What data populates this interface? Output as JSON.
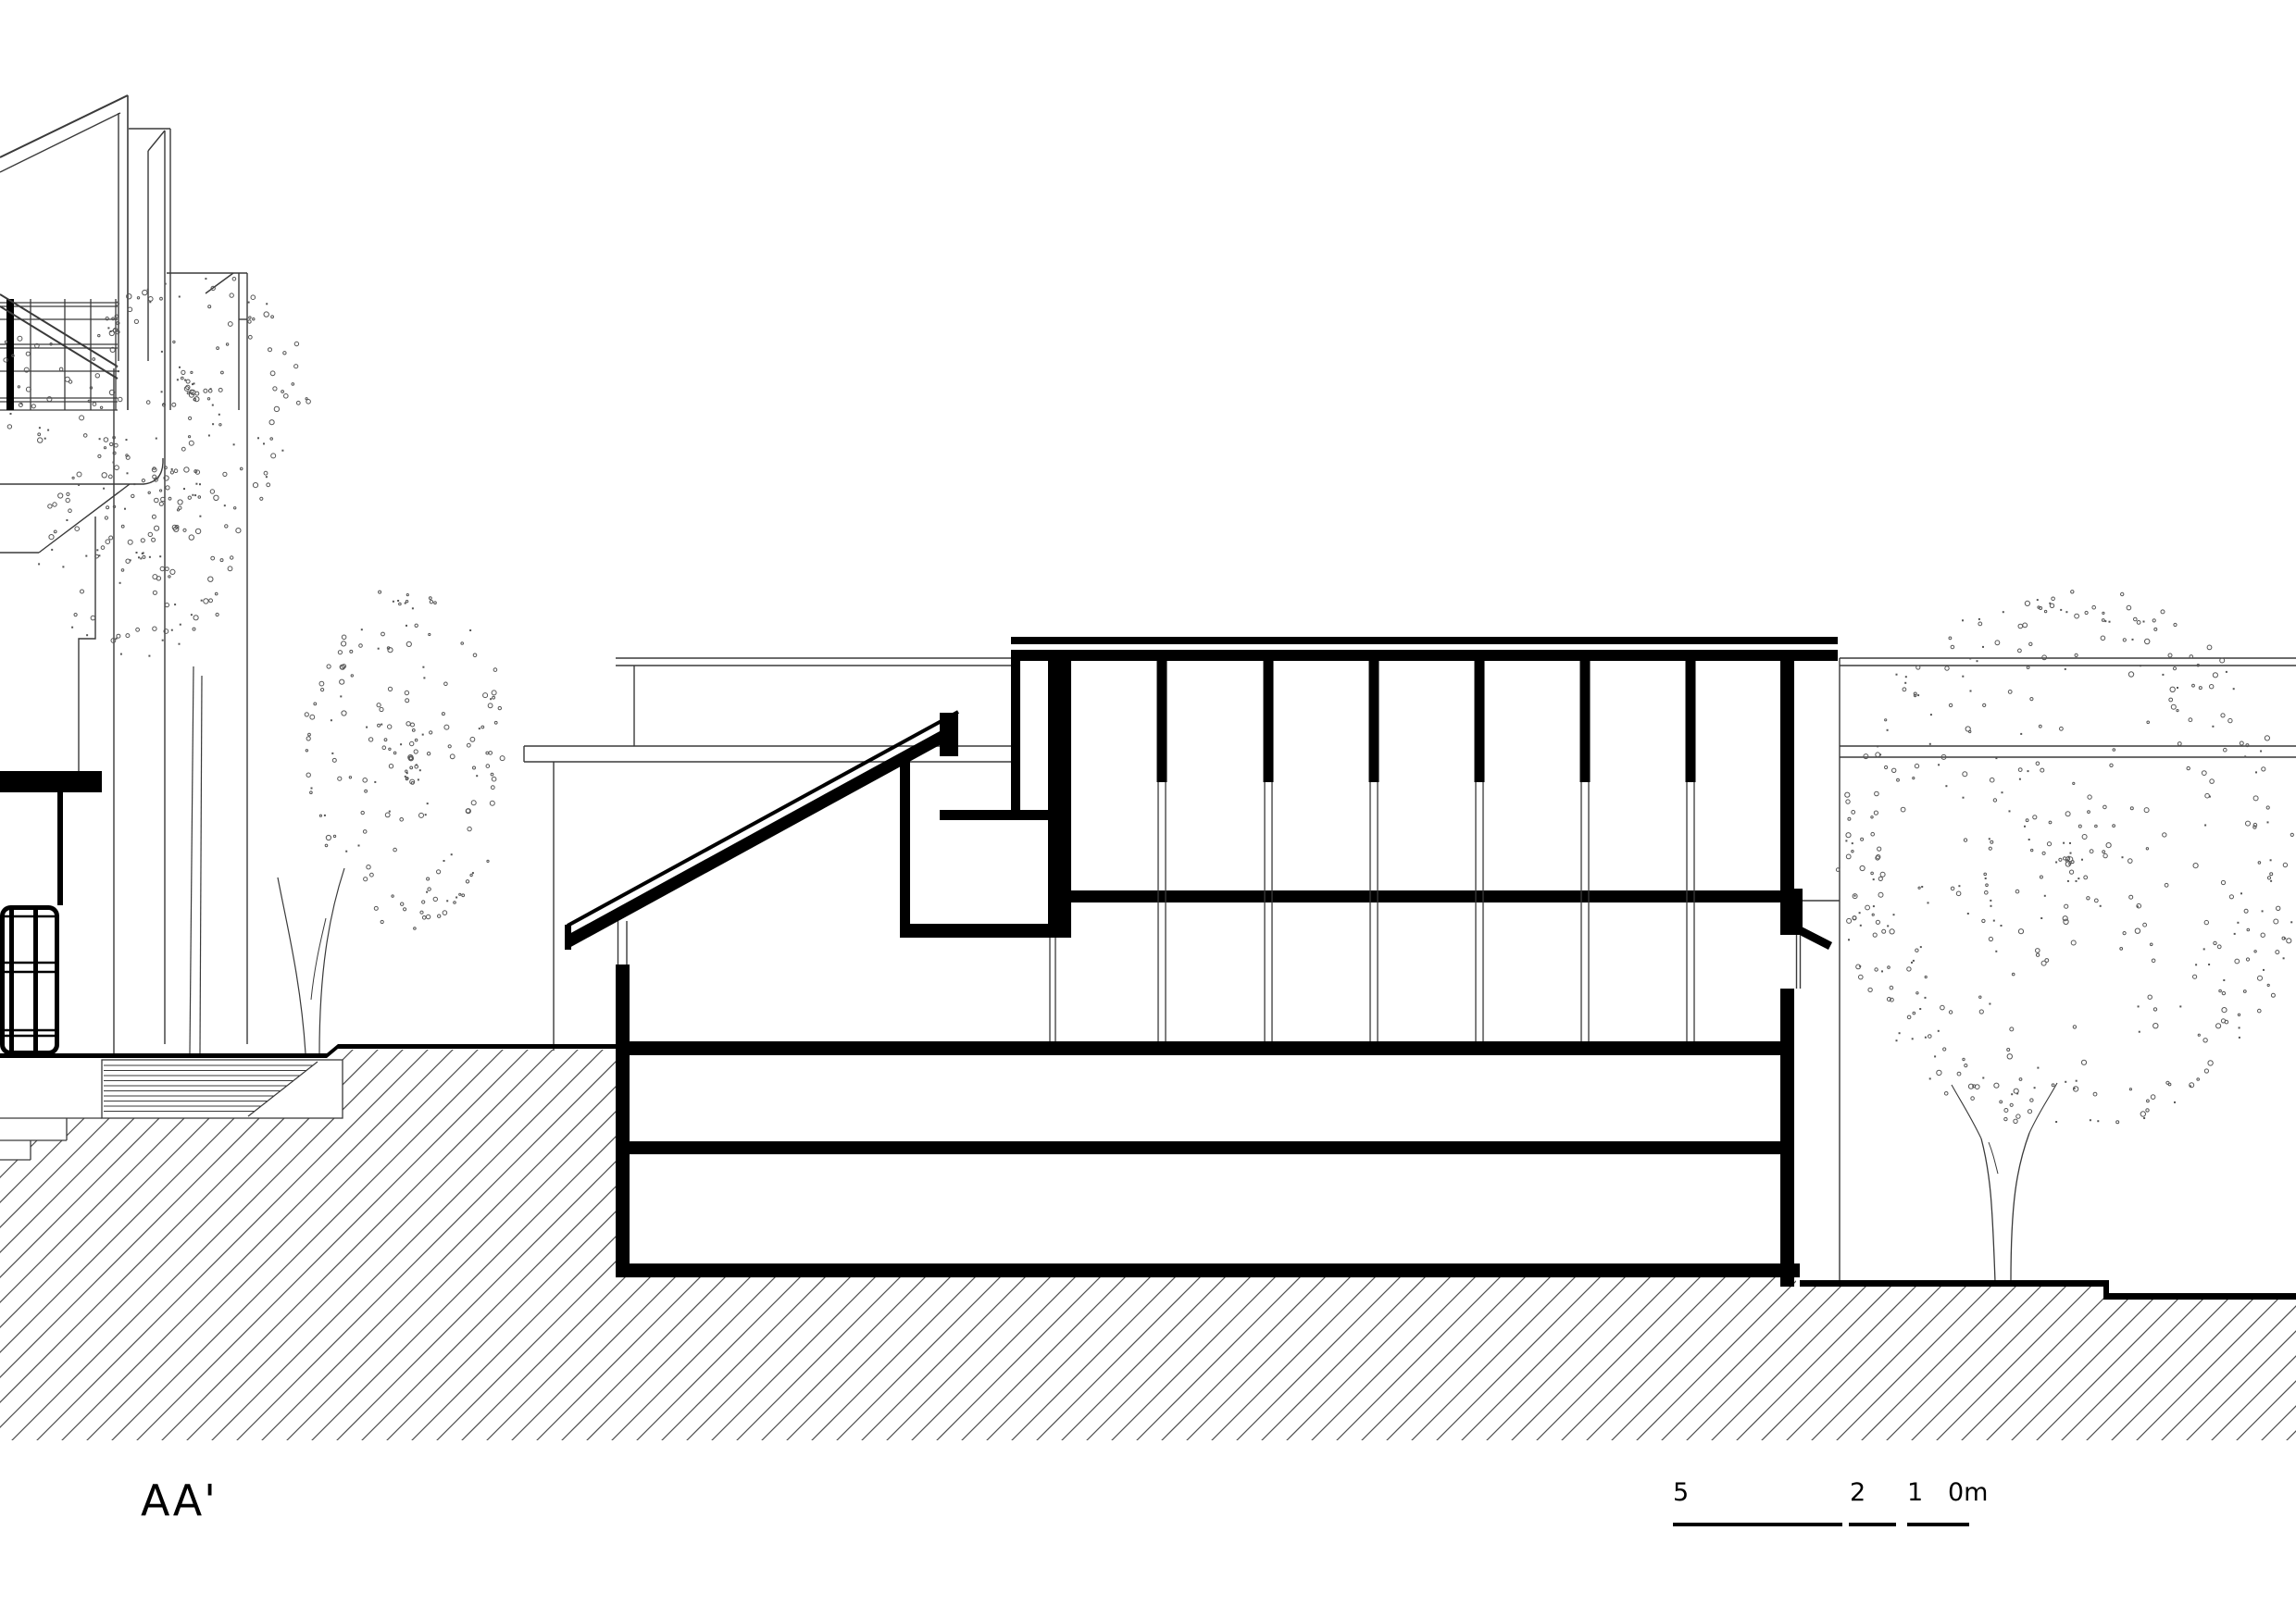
{
  "drawing": {
    "title": "AA'",
    "type": "architectural-section-elevation"
  },
  "scale_bar": {
    "labels": [
      "5",
      "2",
      "1",
      "0m"
    ]
  },
  "colors": {
    "ink": "#000000",
    "thin_line": "#3a3a3a",
    "hatch": "#4d4d4d",
    "foliage": "#555555",
    "background": "#ffffff"
  }
}
